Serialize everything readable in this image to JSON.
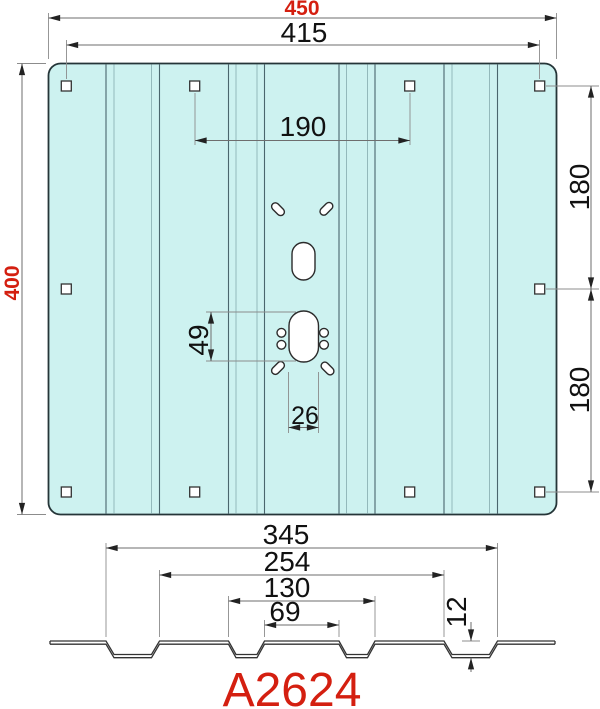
{
  "drawing": {
    "part_number": "A2624",
    "colors": {
      "accent_red": "#d41f10",
      "plate_fill": "#cdf2f0",
      "outline_dark": "#253538"
    },
    "top_view": {
      "width_total": "450",
      "width_holes_outer": "415",
      "width_holes_inner": "190",
      "height_total": "400",
      "side_spacing_upper": "180",
      "side_spacing_lower": "180",
      "slot_height": "49",
      "slot_width": "26"
    },
    "profile": {
      "span_ribs_outer": "345",
      "span_ribs_inner": "254",
      "span_center_outer": "130",
      "span_center_inner": "69",
      "rib_depth": "12"
    }
  }
}
